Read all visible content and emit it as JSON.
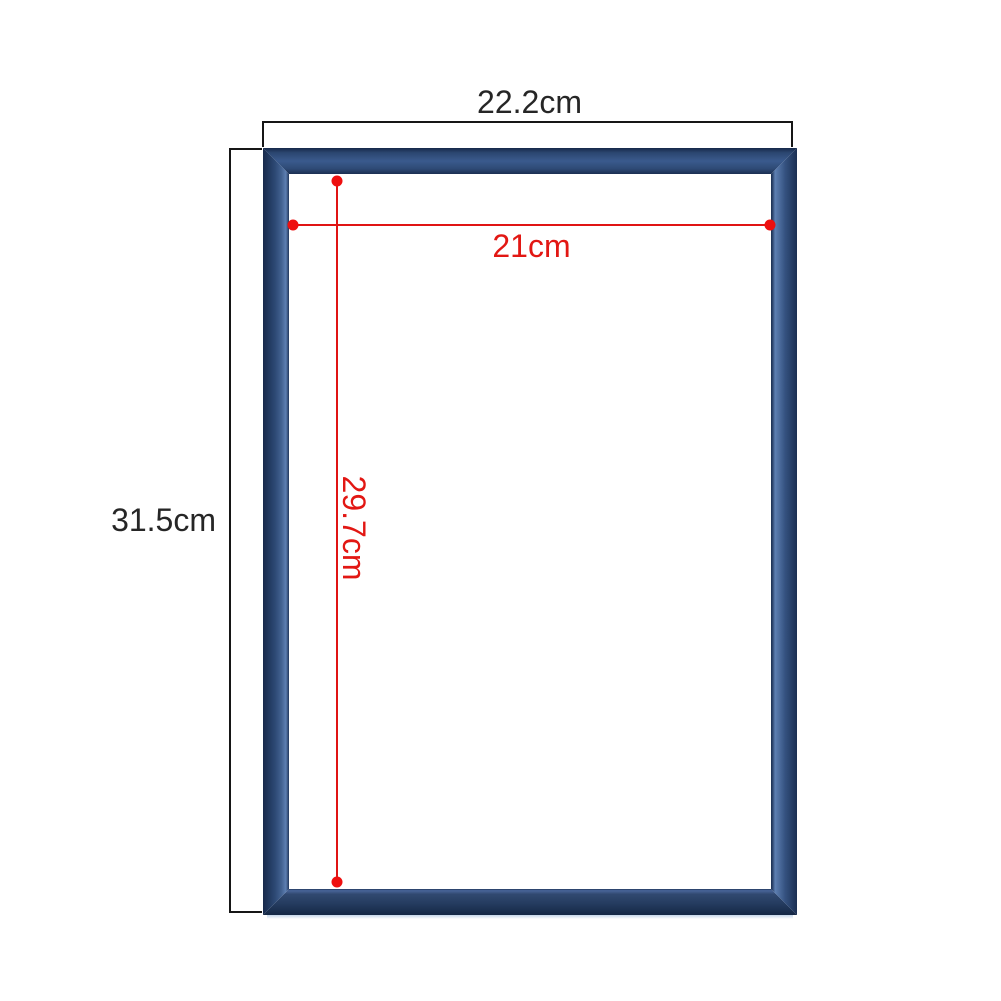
{
  "diagram": {
    "type": "product-dimension-diagram",
    "subject": "blue picture frame",
    "labels": {
      "outer_width": "22.2cm",
      "outer_height": "31.5cm",
      "inner_width": "21cm",
      "inner_height": "29.7cm"
    },
    "measurements": {
      "outer_width_cm": 22.2,
      "outer_height_cm": 31.5,
      "inner_width_cm": 21,
      "inner_height_cm": 29.7
    },
    "colors": {
      "frame_blue": "#2f4c78",
      "frame_highlight_blue": "#5d7fb2",
      "frame_dark_blue": "#16294a",
      "dimension_red": "#e01414",
      "bracket_black": "#161616",
      "text_black": "#262626",
      "background": "#ffffff"
    }
  }
}
